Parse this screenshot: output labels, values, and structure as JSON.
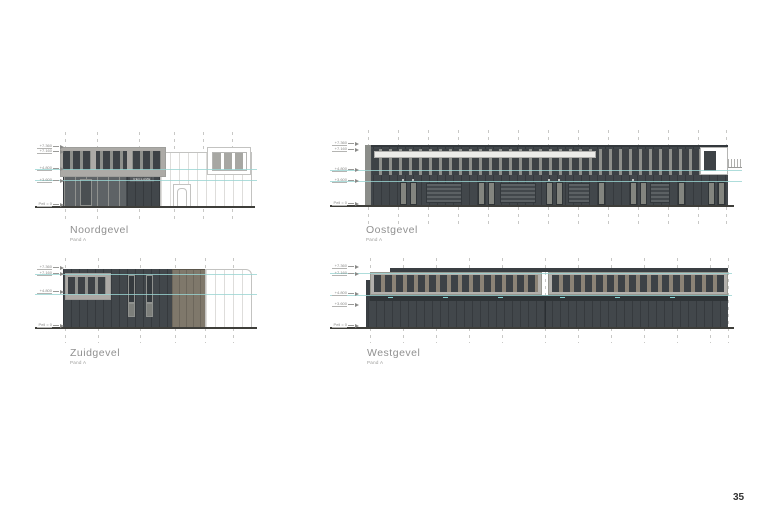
{
  "page": {
    "number": "35"
  },
  "elevations": [
    {
      "id": "noord",
      "title": "Noordgevel",
      "subtitle": "Pand A",
      "sign_label": "RECLAME"
    },
    {
      "id": "oost",
      "title": "Oostgevel",
      "subtitle": "Pand A"
    },
    {
      "id": "zuid",
      "title": "Zuidgevel",
      "subtitle": "Pand A"
    },
    {
      "id": "west",
      "title": "Westgevel",
      "subtitle": "Pand A"
    }
  ],
  "levels": [
    "+7.360",
    "+7.160",
    "+4.800",
    "+3.600",
    "Peil = 0"
  ],
  "colors": {
    "facade-dark": "#42474b",
    "window-pane": "#3d4246",
    "mullion": "#8e908c",
    "frame-light": "#acaaa6",
    "band-mullion": "#8b8376",
    "tan": "#7f786b",
    "outline": "#c3c3c1",
    "outline-stripe": "#dedddb",
    "teal": "#9ad4d2",
    "ground": "#3e3e3a",
    "grid": "#c8c8c6",
    "glass": "#5e6366",
    "door-light": "#83857f",
    "white-strip": "#ecece9",
    "text-gray": "#909090",
    "text-dark": "#333333"
  }
}
